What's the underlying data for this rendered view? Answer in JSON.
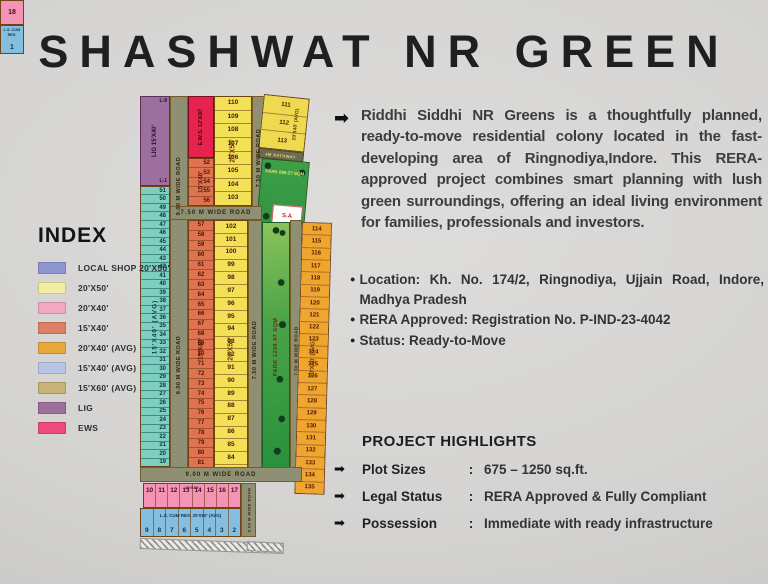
{
  "title": "SHASHWAT NR GREEN",
  "icons": {
    "arrow": "➡",
    "bullet": "●"
  },
  "description": "Riddhi Siddhi NR Greens is a thoughtfully planned, ready-to-move residential colony located in the fast-developing area of Ringnodiya,Indore. This RERA-approved project combines smart planning with lush green surroundings, offering an ideal living environment for families, professionals and investors.",
  "bullets": [
    "Location: Kh. No. 174/2, Ringnodiya, Ujjain Road, Indore, Madhya Pradesh",
    "RERA Approved: Registration No. P-IND-23-4042",
    "Status: Ready-to-Move"
  ],
  "highlights": {
    "heading": "PROJECT HIGHLIGHTS",
    "colon": ":",
    "rows": [
      {
        "label": "Plot Sizes",
        "value": "675 – 1250 sq.ft."
      },
      {
        "label": "Legal Status",
        "value": "RERA Approved & Fully Compliant"
      },
      {
        "label": "Possession",
        "value": "Immediate with ready infrastructure"
      }
    ]
  },
  "index": {
    "heading": "INDEX",
    "items": [
      {
        "label": "LOCAL SHOP 20'X50'",
        "color": "#8e97d2"
      },
      {
        "label": "20'X50'",
        "color": "#f2eda2"
      },
      {
        "label": "20'X40'",
        "color": "#f3a9c4"
      },
      {
        "label": "15'X40'",
        "color": "#dc8166"
      },
      {
        "label": "20'X40' (AVG)",
        "color": "#e5a93d"
      },
      {
        "label": "15'X40' (AVG)",
        "color": "#bac5e6"
      },
      {
        "label": "15'X60' (AVG)",
        "color": "#c6b377"
      },
      {
        "label": "LIG",
        "color": "#9e6f9a"
      },
      {
        "label": "EWS",
        "color": "#ee4a7c"
      }
    ]
  },
  "map": {
    "labels": {
      "lig": "LIG 15'X40'",
      "l8": "L-8",
      "l1": "L-1",
      "ews": "E.W.S. 12'X30'",
      "s1540": "15'X40'",
      "s2050": "20'X50'",
      "s2040avg": "20'X40' (AVG)",
      "s1540avg": "15'X40' (AVG)",
      "pathway": "4M PATHWAY",
      "park1": "PARK 699.27 SQM",
      "park2": "PARK 1298.47 SQM",
      "sa": "S.A 175.67 SQM",
      "pink": "20'X40'",
      "blue": "L.S. CUM RES. 20'X50' (AVG)",
      "blue1": "L.S. CUM RES.",
      "plot18": "18",
      "plot1": "1"
    },
    "roads": {
      "nine": "9.00 M WIDE ROAD",
      "seven": "7.50 M WIDE ROAD"
    },
    "plots": {
      "teal": [
        51,
        50,
        49,
        48,
        47,
        46,
        45,
        44,
        43,
        42,
        41,
        40,
        39,
        38,
        37,
        36,
        35,
        34,
        33,
        32,
        31,
        30,
        29,
        28,
        27,
        26,
        25,
        24,
        23,
        22,
        21,
        20,
        19
      ],
      "salmon_top": [
        52,
        53,
        54,
        55,
        56
      ],
      "yellow_top": [
        110,
        109,
        108,
        107,
        106,
        105,
        104,
        103
      ],
      "topright": [
        111,
        112,
        113
      ],
      "salmon_mid": [
        57,
        58,
        59,
        60,
        61,
        62,
        63,
        64,
        65,
        66,
        67,
        68,
        69,
        70,
        71,
        72,
        73,
        74,
        75,
        76,
        77,
        78,
        79,
        80,
        81,
        82
      ],
      "yellow_mid": [
        102,
        101,
        100,
        99,
        98,
        97,
        96,
        95,
        94,
        93,
        92,
        91,
        90,
        89,
        88,
        87,
        86,
        85,
        84,
        83
      ],
      "orange_right": [
        114,
        115,
        116,
        117,
        118,
        119,
        120,
        121,
        122,
        123,
        124,
        125,
        126,
        127,
        128,
        129,
        130,
        131,
        132,
        133,
        134,
        135
      ],
      "pink_row": [
        10,
        11,
        12,
        13,
        14,
        15,
        16,
        17
      ],
      "blue_row": [
        9,
        8,
        7,
        6,
        5,
        4,
        3,
        2
      ]
    }
  }
}
